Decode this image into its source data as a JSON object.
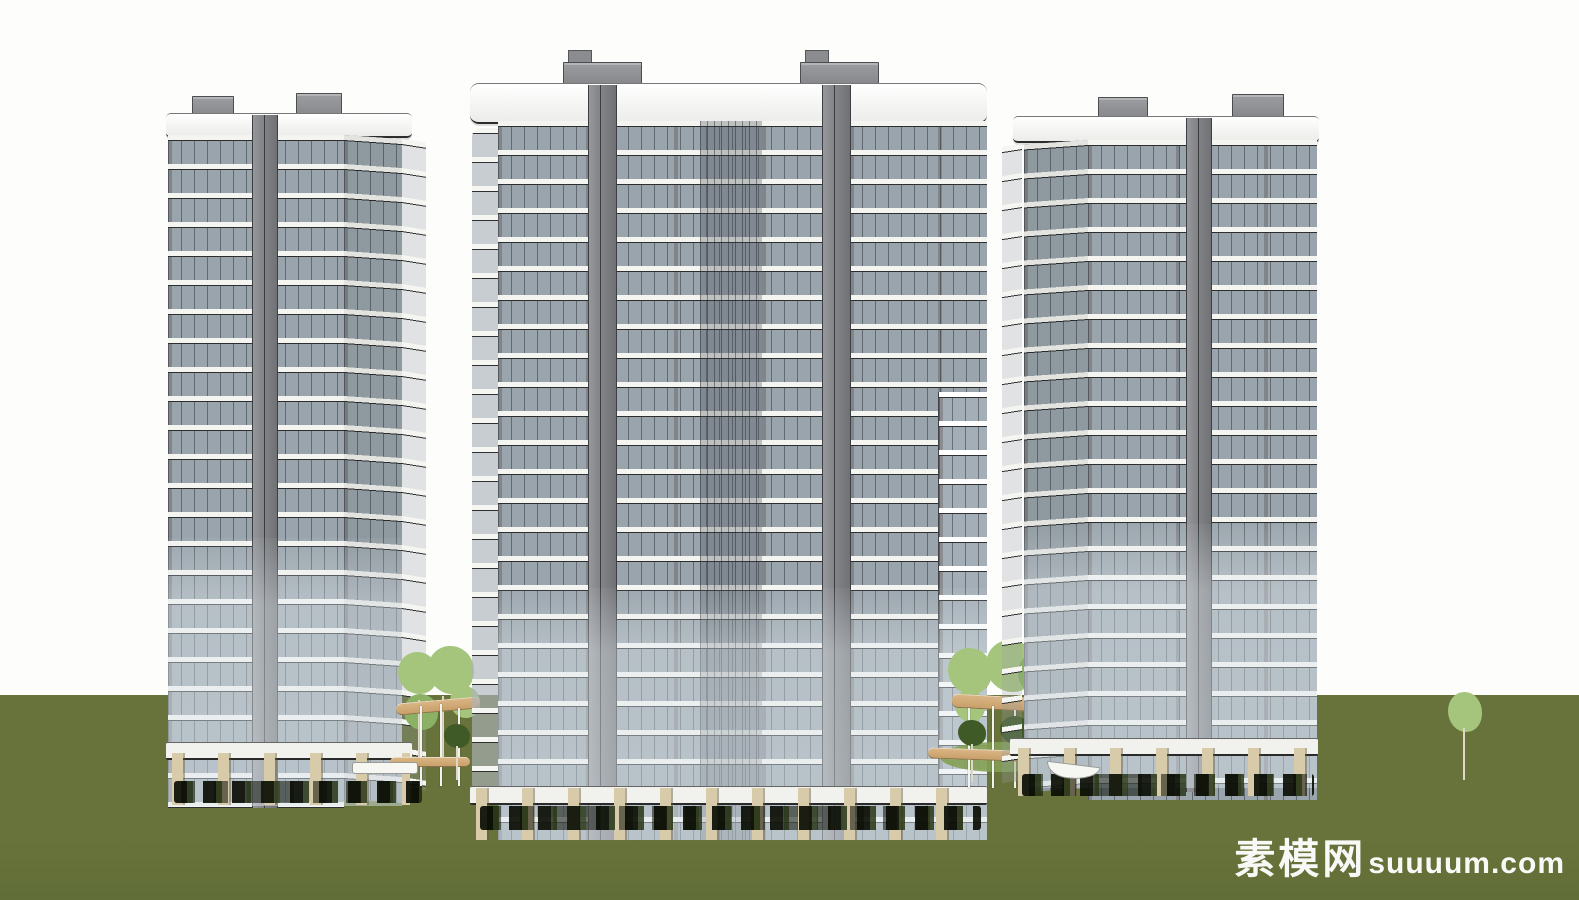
{
  "watermark": {
    "site_name_cn": "素模网",
    "site_domain": "suuuum.com"
  },
  "palette": {
    "sky": "#fdfdfc",
    "ground": "#67733a",
    "facade": "#8e9093",
    "glass": "#9aa4ac",
    "glass_light": "#c6cfd4",
    "slab": "#f4f4f1",
    "slab_line": "#2b2d2e",
    "pier": "#85878b",
    "pier_edge": "#3c3e41",
    "roofbox": "#909295",
    "pillar_tan": "#d8cbaa",
    "walkway_tan": "#d9b483",
    "walkway_tan_dark": "#c9a06a",
    "tree_light": "#a5c57d",
    "tree_mid": "#8bb164",
    "tree_dark": "#3f5a26",
    "shrub_dark": "#12180a",
    "grass_patch": "#83a054",
    "watermark_white": "#ffffff"
  }
}
